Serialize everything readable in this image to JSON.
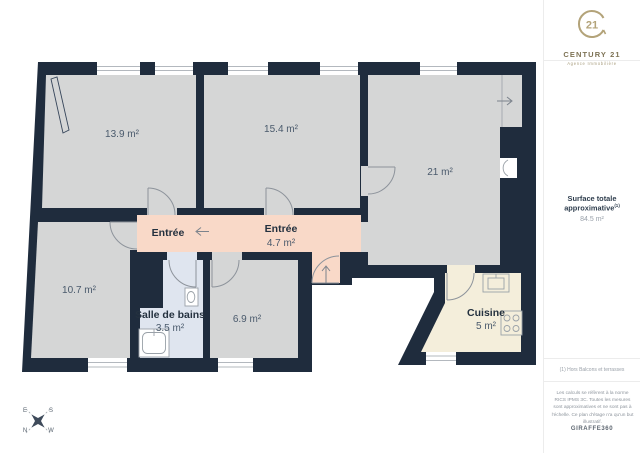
{
  "plan": {
    "rooms": {
      "r139": {
        "area": "13.9 m²"
      },
      "r154": {
        "area": "15.4 m²"
      },
      "r21": {
        "area": "21 m²"
      },
      "entree_west": {
        "name": "Entrée"
      },
      "entree_main": {
        "name": "Entrée",
        "area": "4.7 m²"
      },
      "r107": {
        "area": "10.7 m²"
      },
      "bath": {
        "name": "Salle de bains",
        "area": "3.5 m²"
      },
      "r69": {
        "area": "6.9 m²"
      },
      "kitchen": {
        "name": "Cuisine",
        "area": "5 m²"
      }
    },
    "compass": {
      "e": "E",
      "s": "S",
      "n": "N",
      "w": "W"
    }
  },
  "sidebar": {
    "logo": {
      "number": "21",
      "name": "CENTURY 21",
      "tagline": "Agence Immobilière"
    },
    "surface": {
      "label": "Surface totale approximative",
      "sup": "(1)",
      "value": "84.5 m²"
    },
    "note": "(1) Hors Balcons et terrasses",
    "disclaimer": "Les calculs se réfèrent à la norme RICS IPMS 3C. Toutes les mesures sont approximatives et ne sont pas à l'échelle. Ce plan d'étage n'a qu'un but illustratif.",
    "provider": "GIRAFFE360"
  },
  "colors": {
    "wall": "#1f2c3d",
    "room_fill": "#d5d6d6",
    "hall_fill": "#f9d9c8",
    "bathroom_fill": "#dfe5ef",
    "kitchen_fill": "#f4eedb",
    "brand_gold": "#b3a379",
    "fixture_line": "#9aa1a8"
  }
}
